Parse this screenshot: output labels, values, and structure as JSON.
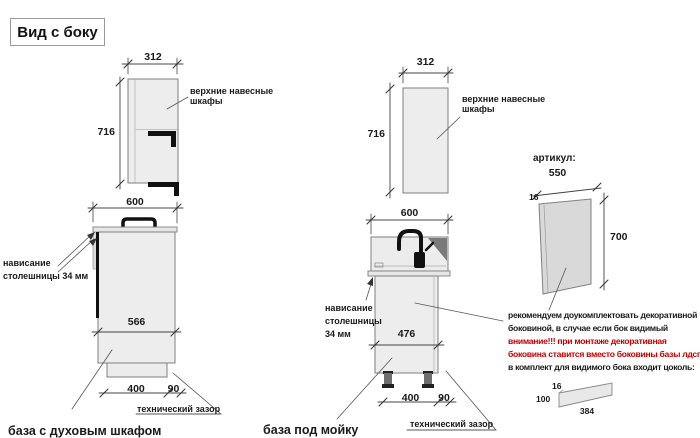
{
  "title": "Вид с боку",
  "left_wall": {
    "dim_width": "312",
    "dim_height": "716",
    "label_line1": "верхние навесные",
    "label_line2": "шкафы"
  },
  "left_base": {
    "dim_width": "600",
    "overhang_line1": "нависание",
    "overhang_line2": "столешницы 34 мм",
    "dim_inner": "566",
    "dim_400": "400",
    "dim_90": "90",
    "tech_gap": "технический зазор",
    "caption": "база с духовым шкафом"
  },
  "mid_wall": {
    "dim_width": "312",
    "dim_height": "716",
    "label_line1": "верхние навесные",
    "label_line2": "шкафы"
  },
  "mid_base": {
    "dim_width": "600",
    "overhang_line1": "нависание",
    "overhang_line2": "столешницы",
    "overhang_line3": "34 мм",
    "dim_inner": "476",
    "dim_400": "400",
    "dim_90": "90",
    "tech_gap": "технический зазор",
    "caption": "база под мойку"
  },
  "panel": {
    "articul": "артикул:",
    "dim_width": "550",
    "dim_thickness": "16",
    "dim_height": "700"
  },
  "note": {
    "line1": "рекомендуем доукомплектовать декоративной",
    "line2": "боковиной, в случае если бок видимый",
    "line3": "внимание!!! при монтаже декоративная",
    "line4": "боковина ставится вместо боковины базы лдсп",
    "line5": "в комплект для видимого бока входит цоколь:"
  },
  "plinth": {
    "dim_16": "16",
    "dim_100": "100",
    "dim_384": "384"
  },
  "colors": {
    "warning_red": "#c00000",
    "cabinet_fill": "#ededed",
    "panel_fill": "#d9d9d9",
    "line": "#7f7f7f"
  }
}
